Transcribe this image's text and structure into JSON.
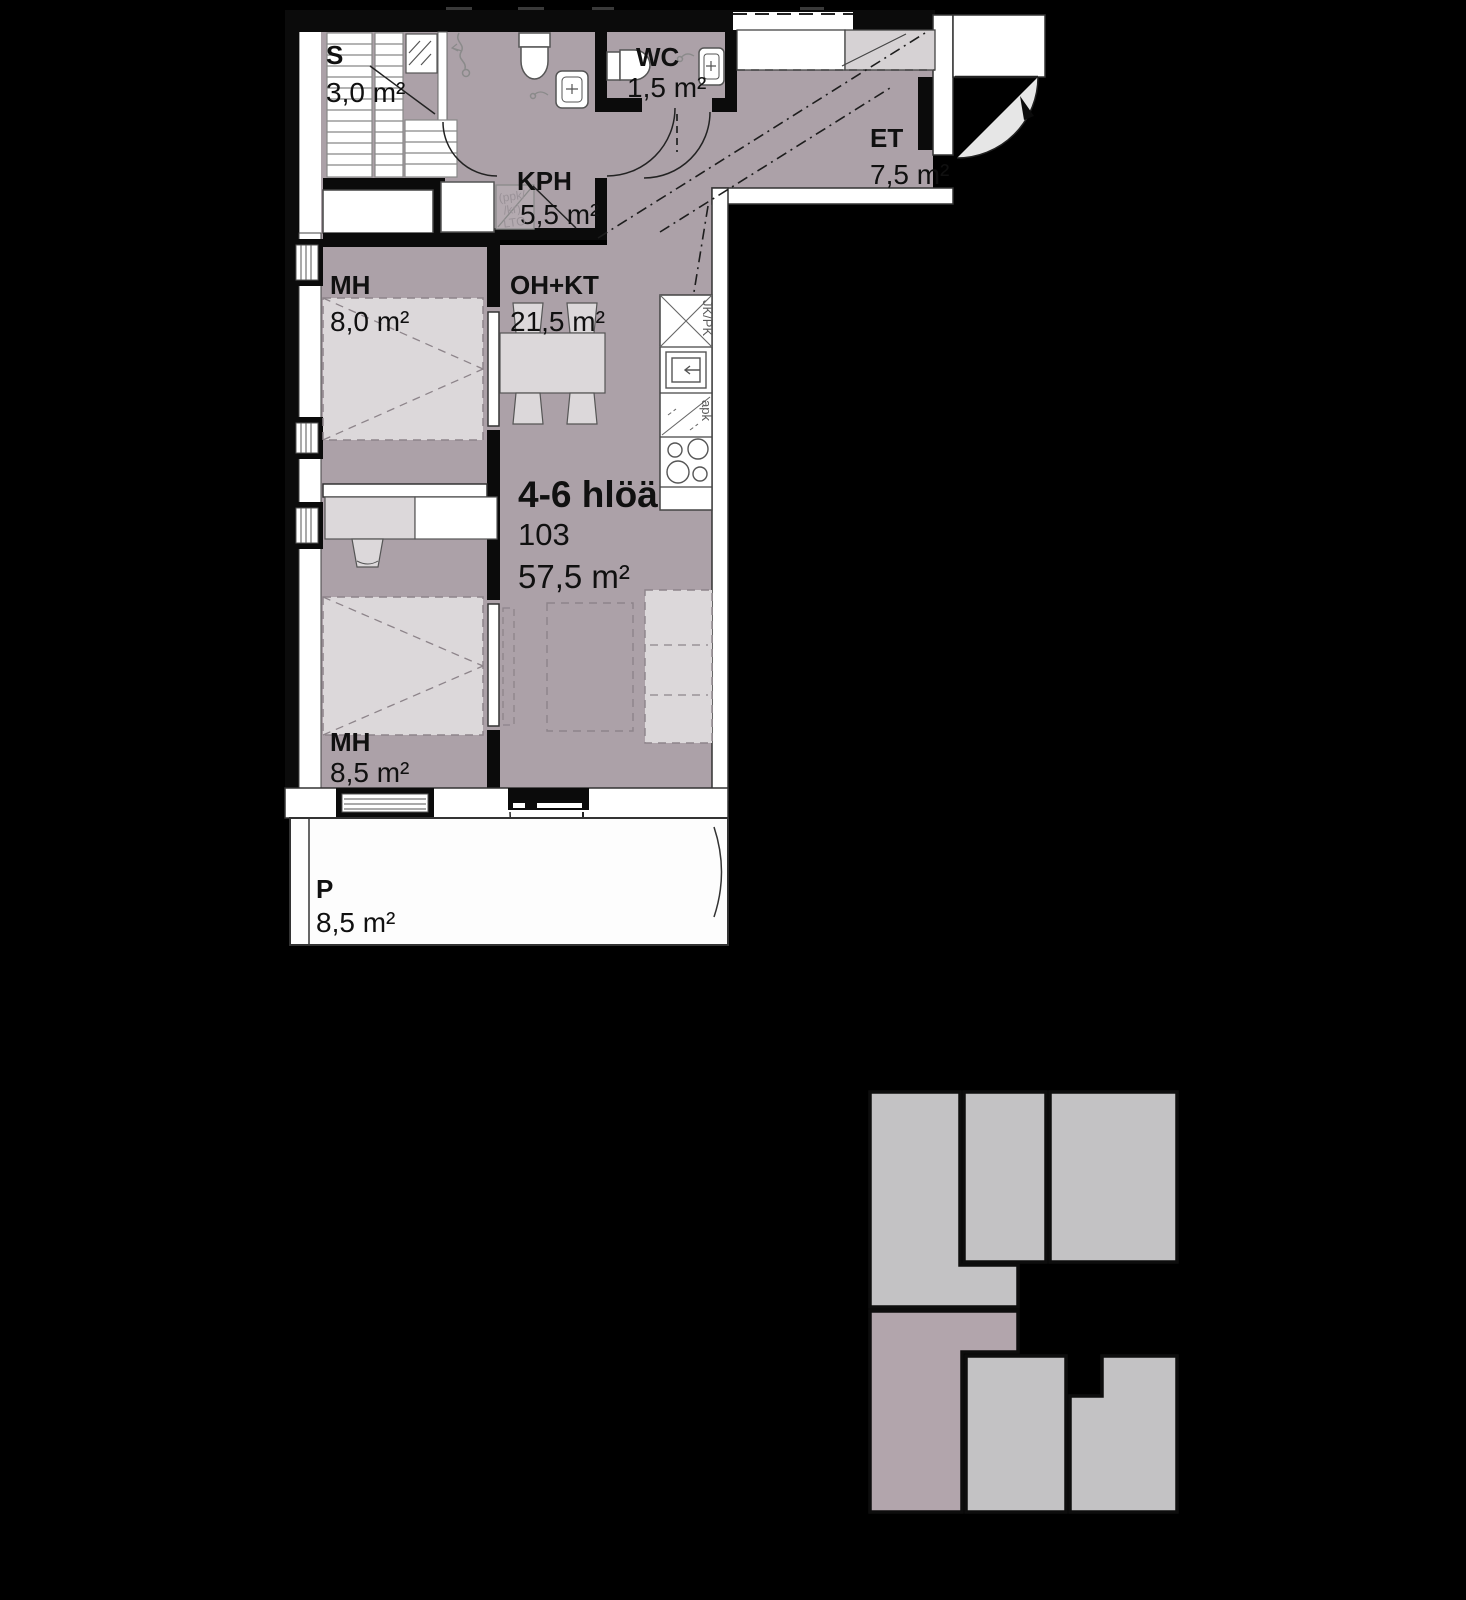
{
  "floor_plan": {
    "rooms": [
      {
        "id": "sauna",
        "label": "S",
        "area": "3,0 m²"
      },
      {
        "id": "kph",
        "label": "KPH",
        "area": "5,5 m²"
      },
      {
        "id": "wc",
        "label": "WC",
        "area": "1,5 m²"
      },
      {
        "id": "et",
        "label": "ET",
        "area": "7,5 m²"
      },
      {
        "id": "bedroom-1",
        "label": "MH",
        "area": "8,0 m²"
      },
      {
        "id": "living-kitchen",
        "label": "OH+KT",
        "area": "21,5 m²"
      },
      {
        "id": "bedroom-2",
        "label": "MH",
        "area": "8,5 m²"
      },
      {
        "id": "balcony",
        "label": "P",
        "area": "8,5 m²"
      }
    ],
    "apartment": {
      "occupancy": "4-6 hlöä",
      "unit_number": "103",
      "total_area": "57,5 m²"
    },
    "appliance_labels": {
      "fridge_freezer": "JK/PK",
      "dishwasher": "apk",
      "utility_reservation": [
        "(ppk/",
        "/kr)",
        "LTO"
      ]
    },
    "colors": {
      "background": "#000000",
      "floor": "#aca1a8",
      "wall": "#0b0b0b",
      "furniture_light": "#dcd8da",
      "fixture_white": "#ffffff",
      "closet_gray": "#d6d2d4",
      "siteplan_unit": "#c3c2c4",
      "siteplan_highlight": "#b2a5ac"
    }
  }
}
